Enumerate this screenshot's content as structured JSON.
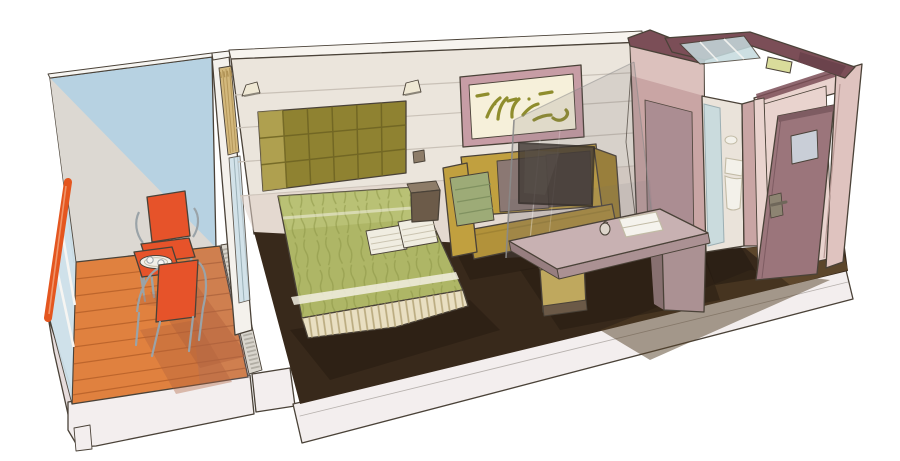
{
  "scene": {
    "kind": "hand-drawn cutaway illustration",
    "subject": "ship cabin with balcony",
    "objects": [
      "balcony deck",
      "balcony partition wall",
      "glass balustrade",
      "orange handrail",
      "two orange balcony chairs",
      "balcony table with tray and cups",
      "curtain",
      "sliding-door glass",
      "tufted headboard",
      "wall sconces",
      "double bed with green spread",
      "pleated bed skirt",
      "folded towels",
      "nightstand",
      "mustard sofa",
      "throw blanket",
      "sofa cushions",
      "framed abstract artwork",
      "glass partition",
      "wall-mounted tv",
      "desk",
      "stool",
      "notebook",
      "kettle",
      "mauve wall with mirror",
      "bathroom doorway",
      "shower glass",
      "toilet",
      "roof cutaway",
      "skylight glass",
      "ceiling light",
      "entrance door",
      "door mirror",
      "door handle",
      "dark carpet",
      "vestibule floor",
      "ship hull base"
    ]
  },
  "palette": {
    "outline": "#4a4238",
    "hull": "#f3eeee",
    "hullShade": "#e6dcdc",
    "balconyWallBlue": "#b7d2e2",
    "balconyWallGray": "#dcd8d2",
    "deck": "#e0813f",
    "deckLine": "#b55f28",
    "deckShadowWarm": "#b0603c",
    "deckShadowCool": "#8d7a92",
    "railOrange": "#e4561f",
    "balustradeGlass": "#cde0e9",
    "frameWhite": "#f6f5f2",
    "chairOrange": "#e6532a",
    "chairFrame": "#9aa3a8",
    "trayWhite": "#f1efe8",
    "wallCut": "#f4f1ec",
    "curtainTan": "#d3b87c",
    "curtainLine": "#ad8f52",
    "glassEdge": "#8fa6ad",
    "roomWall": "#ebe5dc",
    "roomWallLine": "#c9c1b7",
    "roomWallPink": "#dfd0c7",
    "ceiling": "#f7f4ef",
    "sconce": "#efe8d4",
    "sconceShade": "#8a8478",
    "headboard": "#8f8231",
    "headboardDark": "#6e6322",
    "headboardLight": "#c0b060",
    "bedspread": "#aeb666",
    "bedTexture": "#8c9546",
    "bedHighlight": "#cbd18b",
    "bedStripe": "#f2efe2",
    "skirt": "#e9dfc2",
    "skirtStripe": "#b5a578",
    "towel": "#f0ede1",
    "towelLine": "#c2bba6",
    "carpet": "#38291b",
    "carpetLight": "#543f26",
    "vestibuleFloor": "#61492d",
    "shadowDark": "#231910",
    "nightstand": "#6c5b49",
    "nightstandTop": "#8d7c68",
    "sofa": "#c1a03f",
    "sofaDark": "#a18433",
    "sofaSeat": "#b2923a",
    "throw": "#9dab77",
    "throwLine": "#7d8f5e",
    "cushion": "#8b7873",
    "cushionDark": "#75625f",
    "artFrame": "#c79da5",
    "artCanvas": "#f6f0da",
    "artStroke": "#8f8d2d",
    "mauveWall": "#c9a5a4",
    "mauveWallDark": "#a98b91",
    "maroonTop": "#7b4e57",
    "maroonTopDark": "#6b434c",
    "bathInterior": "#eae3da",
    "showerGlass": "#c5dade",
    "toilet": "#f3f1ea",
    "fixtureLight": "#d9dc9b",
    "entranceDoor": "#9b757b",
    "doorEdgeDark": "#7e5c62",
    "doorMirror": "#c9ced7",
    "doorHandle": "#8d8472",
    "doorFrame": "#e9d3ce",
    "rightWall": "#dfc3bf",
    "rightWallTrim": "#b99a96",
    "glassTint": "#6f6a72",
    "glassLine": "#8a8a8a",
    "tv": "#443c37",
    "tvReflect": "#5a524c",
    "deskTop": "#c8b1b2",
    "deskSide": "#ab9193",
    "deskDark": "#977e80",
    "stool": "#bfa85e",
    "stoolBase": "#6b5947",
    "notebook": "#f5f3ed",
    "grate": "#d9d5cd",
    "grateLine": "#8a857c"
  }
}
